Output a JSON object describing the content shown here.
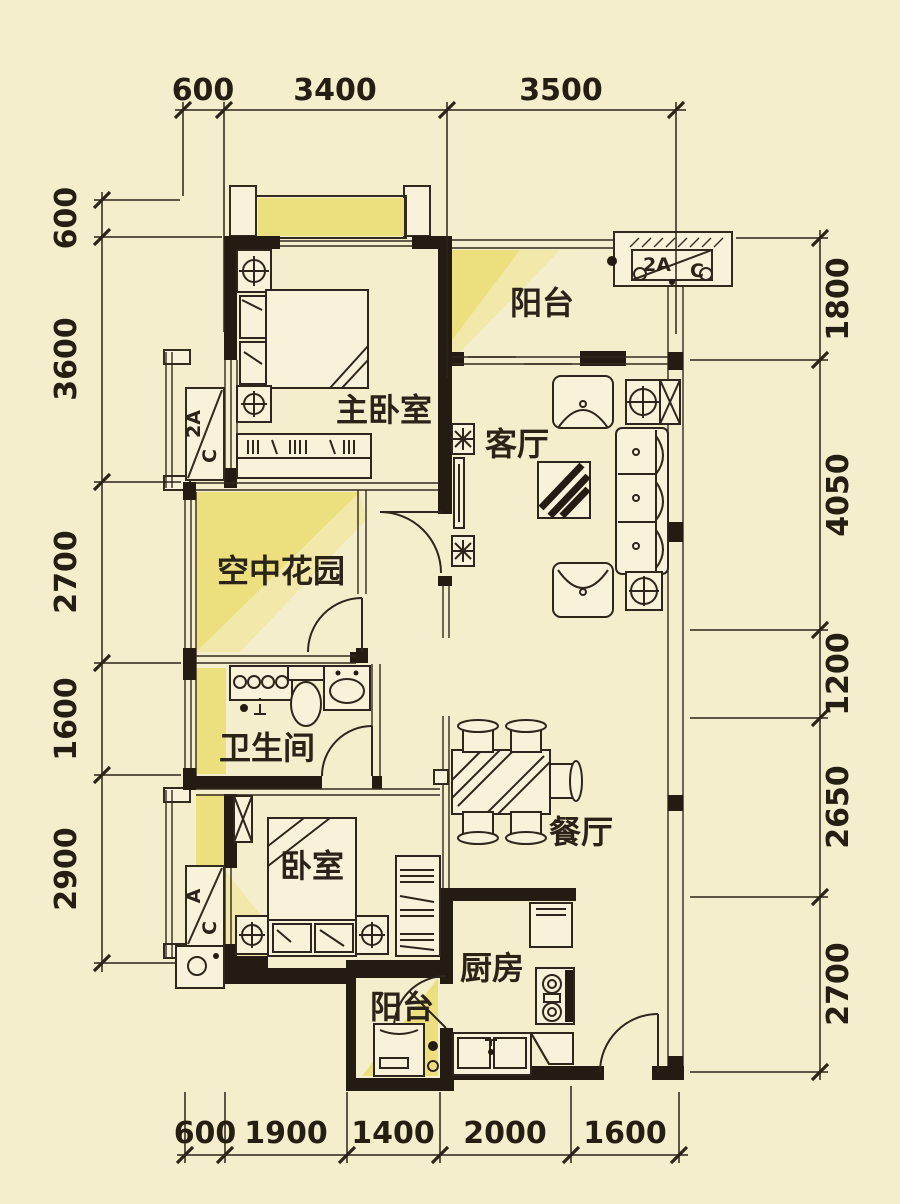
{
  "page": {
    "type": "apartment-floor-plan",
    "background": "#f5eecd"
  },
  "colors": {
    "background": "#f5eecd",
    "sunlight_yellow": "#ecdf7e",
    "sunlight_pale": "#f2e8a9",
    "wall_black": "#241c12",
    "line_dark": "#332a1e",
    "text_dark": "#251e12"
  },
  "rooms": {
    "master_bedroom": "主卧室",
    "balcony_top": "阳台",
    "living_room": "客厅",
    "sky_garden": "空中花园",
    "bathroom": "卫生间",
    "bedroom": "卧室",
    "dining_room": "餐厅",
    "kitchen": "厨房",
    "balcony_bottom": "阳台"
  },
  "ac_units": {
    "top_right": {
      "left": "2A",
      "right": "C"
    },
    "master_left": {
      "left": "2A",
      "right": "C"
    },
    "bedroom_left": {
      "left": "A",
      "right": "C"
    }
  },
  "dimensions": {
    "top": [
      "600",
      "3400",
      "3500"
    ],
    "left": [
      "600",
      "3600",
      "2700",
      "1600",
      "2900"
    ],
    "right": [
      "1800",
      "4050",
      "1200",
      "2650",
      "2700"
    ],
    "bottom": [
      "600",
      "1900",
      "1400",
      "2000",
      "1600"
    ]
  }
}
